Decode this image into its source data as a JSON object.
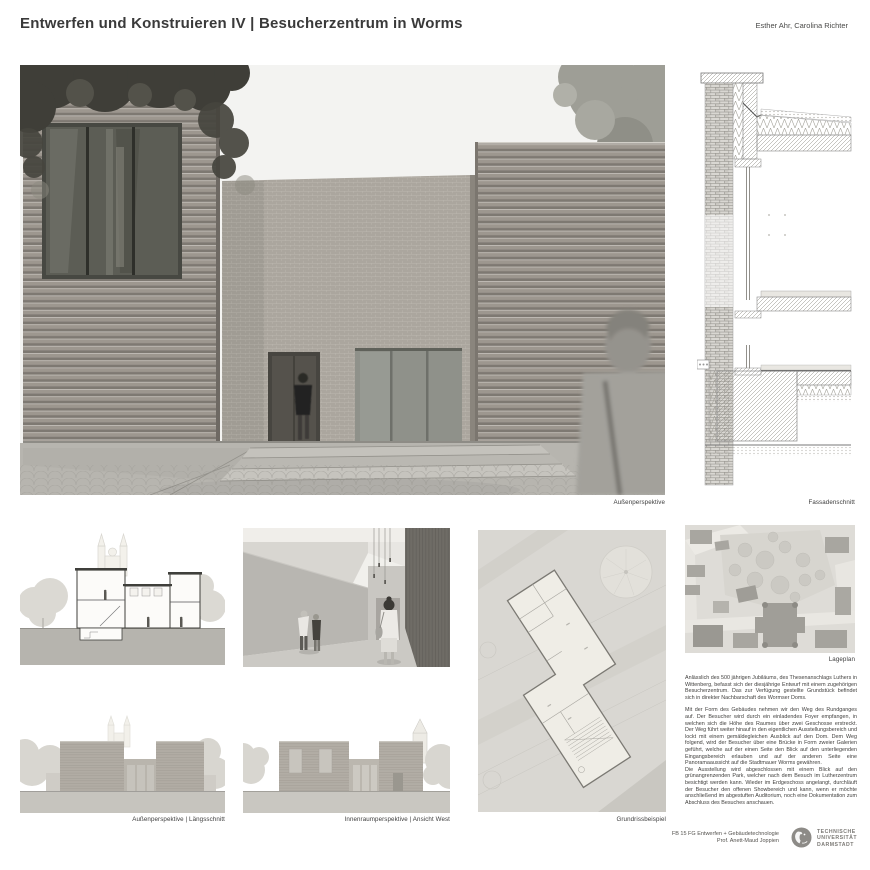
{
  "header": {
    "title": "Entwerfen und Konstruieren IV | Besucherzentrum in Worms",
    "authors": "Esther Ahr, Carolina Richter"
  },
  "captions": {
    "main": "Außenperspektive",
    "facade": "Fassadenschnitt",
    "left_column": "Außenperspektive | Längsschnitt",
    "center_column": "Innenraumperspektive | Ansicht West",
    "floor_plan": "Grundrissbeispiel",
    "site_plan": "Lageplan"
  },
  "description": {
    "para1": "Anlässlich des 500 jährigen Jubiläums, des Thesenanschlags Luthers in Wittenberg, befasst sich der diesjährige Entwurf mit einem zugehörigen Besucherzentrum. Das zur Verfügung gestellte Grundstück befindet sich in direkter Nachbarschaft des Wormser Doms.",
    "para2": "Mit der Form des Gebäudes nehmen wir den Weg des Rundganges auf. Der Besucher wird durch ein einladendes Foyer empfangen, in welchen sich die Höhe des Raumes über zwei Geschosse erstreckt. Der Weg führt weiter hinauf in den eigentlichen Ausstellungsbereich und lockt mit einem gemäldegleichen Ausblick auf den Dom. Dem Weg folgend, wird der Besucher über eine Brücke in Form zweier Galerien geführt, welche auf der einen Seite den Blick auf den unterliegenden Eingangsbereich erlauben und auf der anderen Seite eine Panoramaaussicht auf die Stadtmauer Worms gewähren.",
    "para3": "Die Ausstellung wird abgeschlossen mit einem Blick auf den grünangrenzenden Park, welcher nach dem Besuch im Lutherzentrum besichtigt werden kann. Wieder im Erdgeschoss angelangt, durchläuft der Besucher den offenen Showbereich und kann, wenn er möchte anschließend im abgestuften Auditorium, noch eine Dokumentation zum Abschluss des Besuches anschauen."
  },
  "footer": {
    "department": "FB 15 FG Entwerfen + Gebäudetechnologie",
    "professor": "Prof. Anett-Maud Joppien",
    "university_line1": "TECHNISCHE",
    "university_line2": "UNIVERSITÄT",
    "university_line3": "DARMSTADT"
  },
  "colors": {
    "ink": "#3b3b3b",
    "brick_band": "#9d978f",
    "brick_fine": "#aba69e",
    "sky": "#f3f3f1",
    "glass_dark": "#5c5d55",
    "plaza": "#b7b5af",
    "site_gray": "#d9d7d2"
  }
}
